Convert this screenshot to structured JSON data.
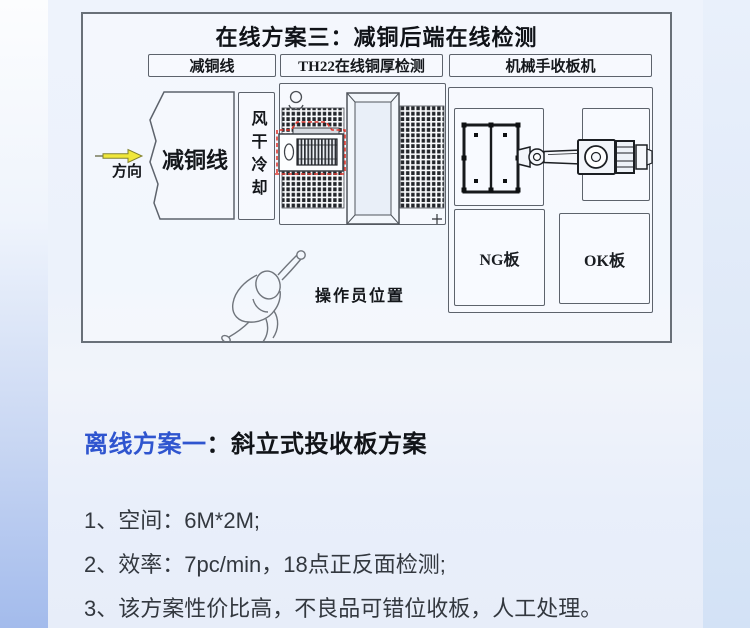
{
  "diagram": {
    "title": "在线方案三：减铜后端在线检测",
    "col_headers": [
      "减铜线",
      "TH22在线铜厚检测",
      "机械手收板机"
    ],
    "direction_label": "方向",
    "reduce_line_label": "减铜线",
    "air_dry_label": "风干冷却",
    "operator_label": "操作员位置",
    "ng_label": "NG板",
    "ok_label": "OK板"
  },
  "offline": {
    "heading_blue": "离线方案一",
    "heading_black": "：斜立式投收板方案",
    "items": [
      "1、空间：6M*2M;",
      "2、效率：7pc/min，18点正反面检测;",
      "3、该方案性价比高，不良品可错位收板，人工处理。"
    ]
  },
  "colors": {
    "accent_blue": "#2f55cf",
    "highlight_red": "#e03a31",
    "arrow_yellow": "#f0e73b",
    "line_dark": "#5d636c"
  }
}
